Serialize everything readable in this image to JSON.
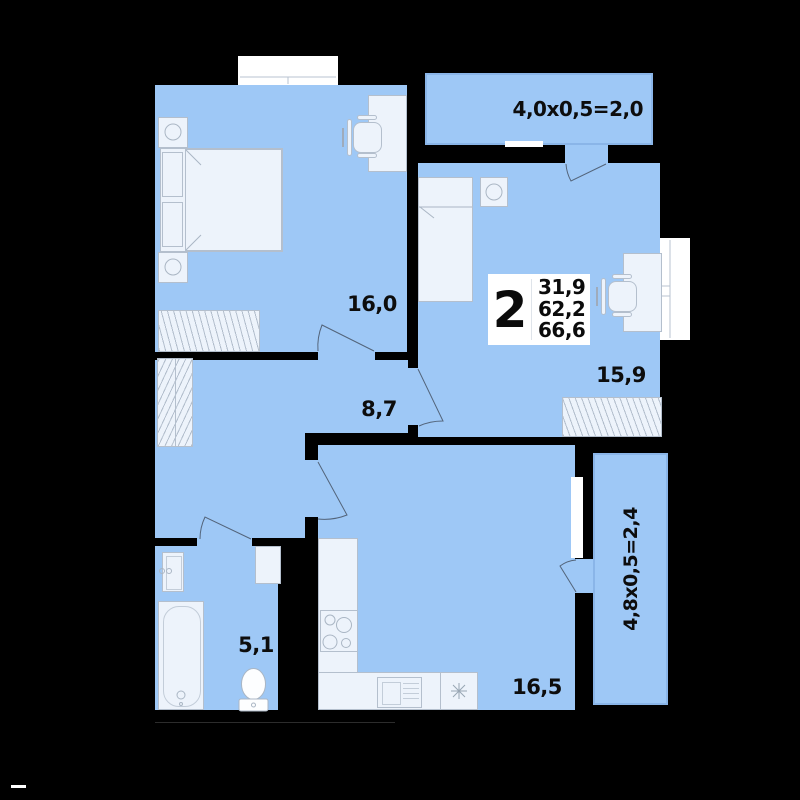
{
  "plan": {
    "type": "apartment-floor-plan",
    "badge": {
      "rooms_count": "2",
      "area_living": "31,9",
      "area_main": "62,2",
      "area_total": "66,6"
    },
    "rooms": {
      "bedroom": {
        "area": "16,0"
      },
      "bedroom2": {
        "area": "15,9"
      },
      "hallway": {
        "area": "8,7"
      },
      "bathroom": {
        "area": "5,1"
      },
      "kitchen_living": {
        "area": "16,5"
      }
    },
    "balconies": {
      "top": {
        "label": "4,0x0,5=2,0"
      },
      "right": {
        "label": "4,8x0,5=2,4"
      }
    }
  },
  "colors": {
    "background": "#000000",
    "room_fill": "#9ec8f6",
    "furniture_fill": "#edf3fb",
    "furniture_stroke": "#b4bfcd",
    "balcony_border": "#8ab5e8",
    "text": "#0d0d0d"
  }
}
